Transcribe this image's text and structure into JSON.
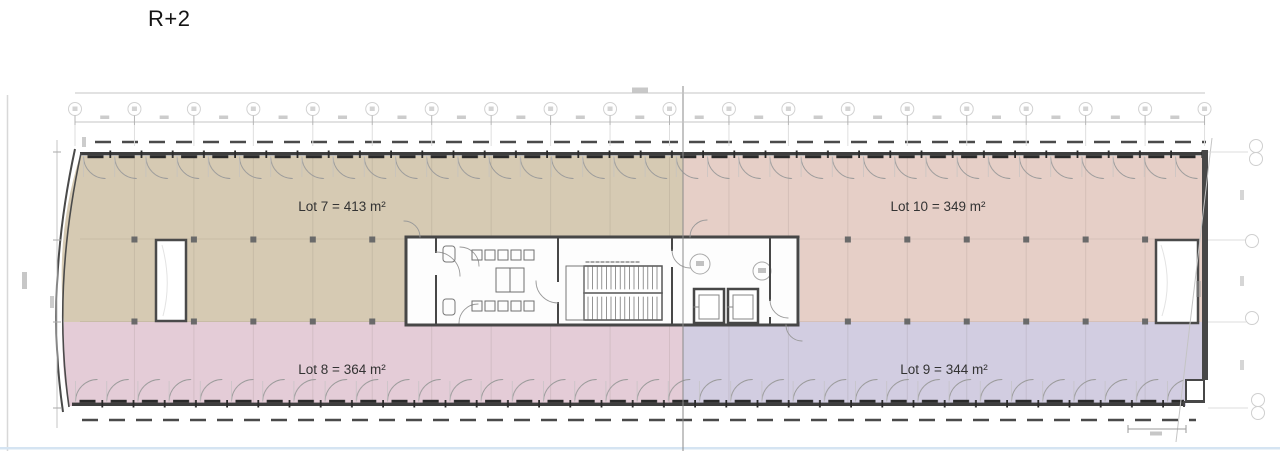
{
  "title": "R+2",
  "lots": [
    {
      "id": "lot-7",
      "label": "Lot 7 = 413 m²",
      "number": 7,
      "area_m2": 413,
      "color": "#d6cab3",
      "position": "upper-left"
    },
    {
      "id": "lot-8",
      "label": "Lot 8 = 364 m²",
      "number": 8,
      "area_m2": 364,
      "color": "#e4ccd7",
      "position": "lower-left"
    },
    {
      "id": "lot-9",
      "label": "Lot 9 = 344 m²",
      "number": 9,
      "area_m2": 344,
      "color": "#d2cde1",
      "position": "lower-right"
    },
    {
      "id": "lot-10",
      "label": "Lot 10 = 349 m²",
      "number": 10,
      "area_m2": 349,
      "color": "#e6cfc7",
      "position": "upper-right"
    }
  ],
  "drawing": {
    "kind": "floor-plan",
    "floor_label": "R+2",
    "core_features": [
      "restrooms",
      "staircase",
      "elevators"
    ]
  }
}
